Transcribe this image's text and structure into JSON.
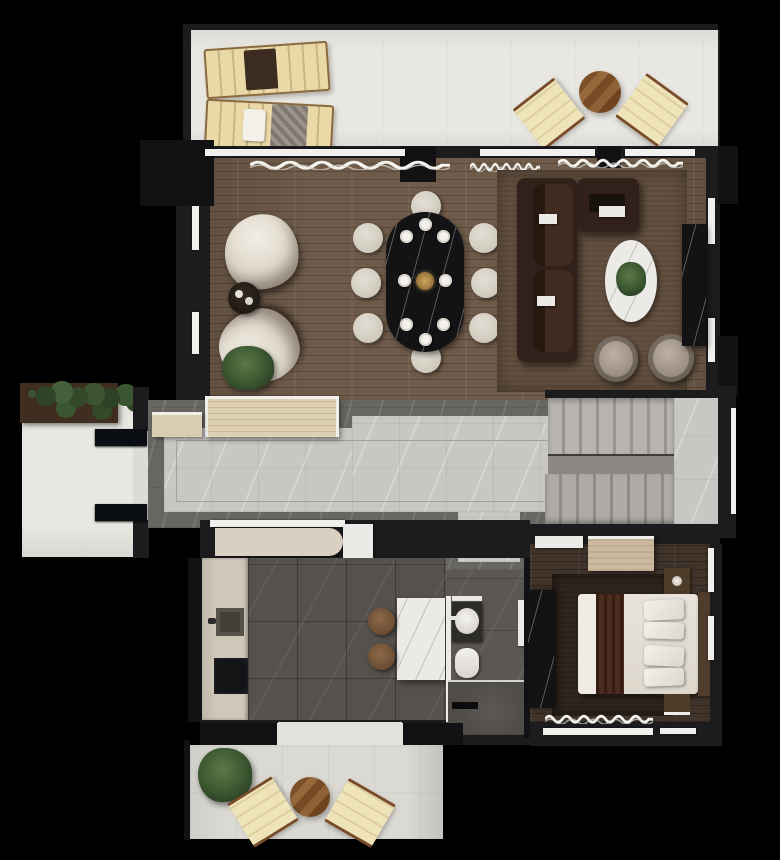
{
  "scene": {
    "kind": "architectural-floor-plan-render",
    "view": "top-down",
    "background_color": "#000000",
    "wall_color": "#1c1c1e"
  },
  "palette": {
    "wood_floor": "#6f5b49",
    "bedroom_floor": "#3f332a",
    "terrace_floor_upper": "#e9e7e2",
    "terrace_floor_lower": "#dbd9d3",
    "hall_marble_light": "#c9c7c3",
    "hall_marble_border": "#686661",
    "kitchen_tile": "#55514c",
    "sofa_leather": "#31211a",
    "marble_white": "#eceae6",
    "marble_black": "#131315",
    "cream_fabric": "#e9e4da",
    "wood_furniture": "#8a5a33",
    "greenery": "#3a5530",
    "bed_runner": "#4a2b1d"
  },
  "rooms": {
    "upper_terrace": {
      "name": "Upper terrace with two sun loungers, round bistro table and two folding chairs"
    },
    "living_dining": {
      "name": "Living and dining room with sofa set, oval dining table for eight, lounge chairs"
    },
    "entry_porch": {
      "name": "Entry porch with planter and double entrance door"
    },
    "hallway": {
      "name": "Hallway with slatted bench and marble floor"
    },
    "staircase": {
      "name": "U-shaped marble staircase with landing"
    },
    "kitchen": {
      "name": "Kitchen with counter, sink, cooktop, marble island and two stools"
    },
    "shower_room": {
      "name": "Shower room with washbasin, toilet and walk-in shower"
    },
    "bedroom": {
      "name": "Bedroom with double bed, rug, dresser, nightstand and wardrobe"
    },
    "lower_terrace": {
      "name": "Lower terrace with plant, round bistro table and two folding chairs"
    }
  },
  "furniture": {
    "upper_terrace": [
      "sun-lounger-with-towel",
      "sun-lounger-with-pillow-blanket",
      "round-wood-table",
      "folding-chair-left",
      "folding-chair-right"
    ],
    "living_dining": [
      "lounge-chair-north",
      "lounge-chair-south",
      "round-side-table",
      "potted-plant",
      "oval-black-marble-dining-table",
      "eight-dining-chairs",
      "place-settings",
      "gold-centerpiece",
      "l-shaped-brown-sofa",
      "oval-white-marble-coffee-table-with-plant",
      "two-swivel-armchairs",
      "black-marble-tv-console",
      "area-rug"
    ],
    "entry_porch": [
      "vine-planter",
      "double-door-leaves"
    ],
    "hallway": [
      "slatted-bench",
      "low-cabinet"
    ],
    "staircase": [
      "upper-flight",
      "handrail-stringer",
      "lower-flight",
      "landing"
    ],
    "kitchen": [
      "counter-run",
      "square-sink",
      "cooktop",
      "marble-island",
      "stool",
      "stool",
      "terrace-door"
    ],
    "shower_room": [
      "vanity-washbasin",
      "toilet",
      "shower-tray",
      "glass-screen",
      "door-leaf"
    ],
    "bedroom": [
      "double-bed",
      "bed-runner",
      "pillows",
      "headboard",
      "dresser",
      "nightstand-with-lamp",
      "black-marble-wardrobe",
      "area-rug",
      "window-curtains"
    ],
    "lower_terrace": [
      "potted-plant",
      "round-wood-table",
      "folding-chair-left",
      "folding-chair-right"
    ]
  },
  "icons": {
    "curtain_wave": "curtain-wave-icon",
    "plant_blob": "plant-icon",
    "sink": "sink-icon",
    "toilet": "toilet-icon"
  }
}
